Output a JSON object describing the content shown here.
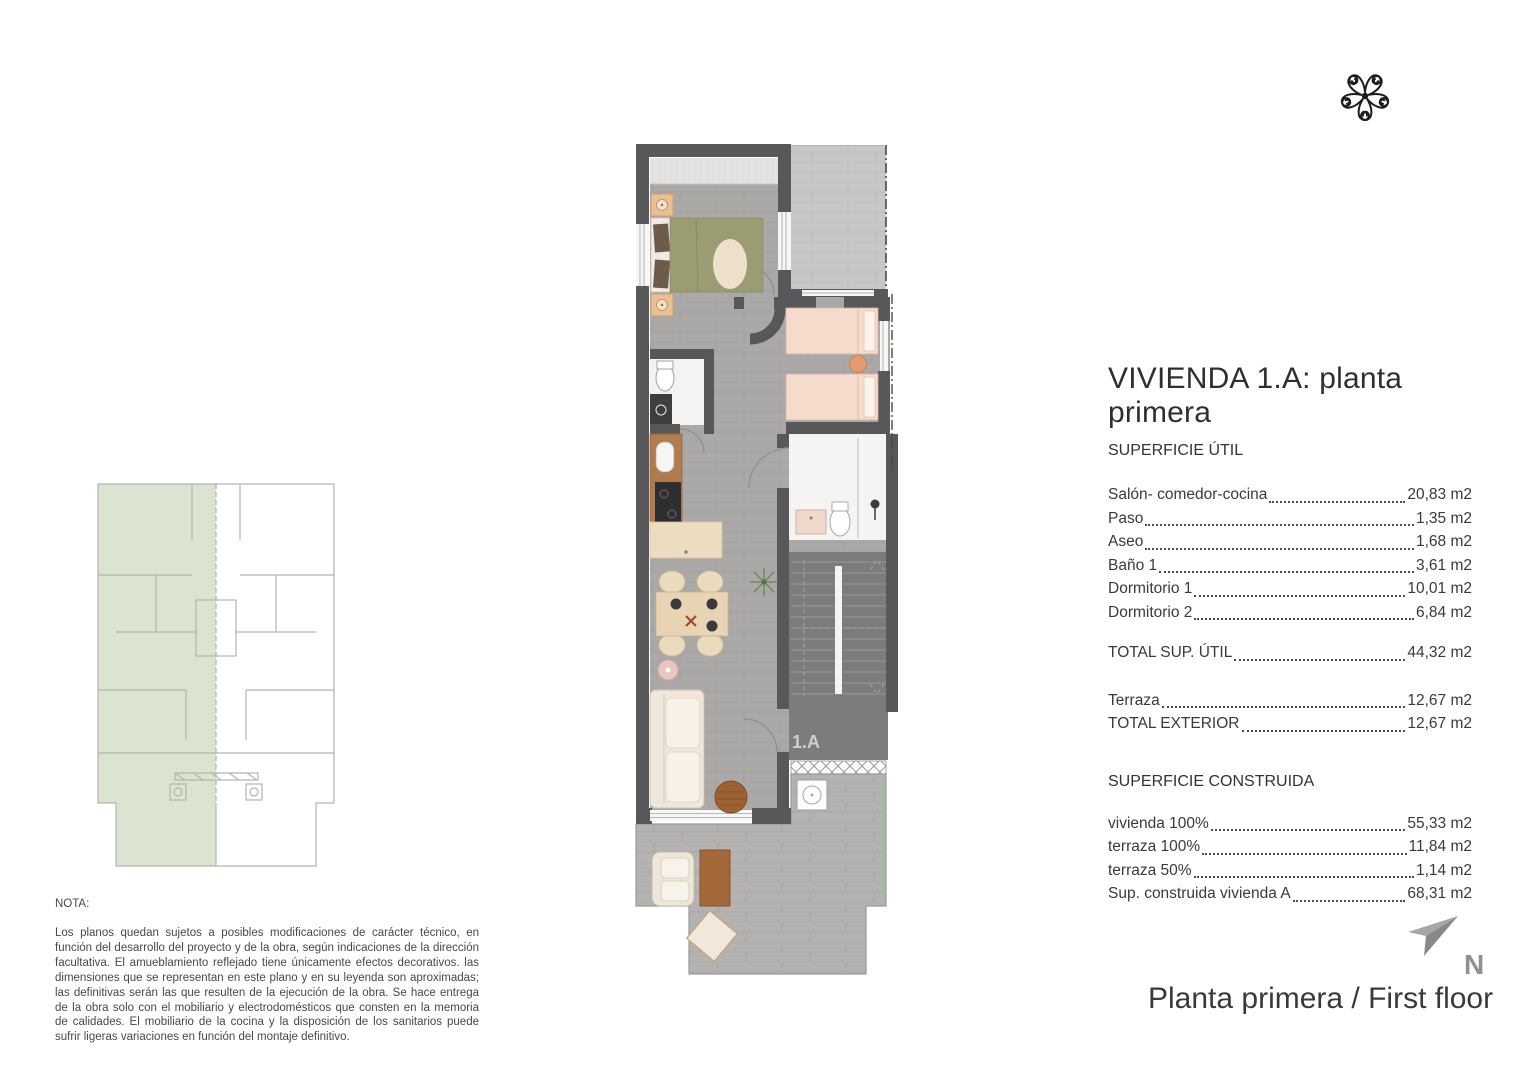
{
  "document": {
    "title": "VIVIENDA 1.A: planta primera",
    "footer_title": "Planta primera / First floor",
    "north_label": "N"
  },
  "superficie_util": {
    "heading": "SUPERFICIE ÚTIL",
    "rows": [
      {
        "label": "Salón- comedor-cocina",
        "value": "20,83 m2"
      },
      {
        "label": "Paso",
        "value": "1,35 m2"
      },
      {
        "label": "Aseo",
        "value": "1,68 m2"
      },
      {
        "label": "Baño 1",
        "value": "3,61 m2"
      },
      {
        "label": "Dormitorio 1",
        "value": "10,01 m2"
      },
      {
        "label": "Dormitorio 2",
        "value": "6,84 m2"
      }
    ],
    "total": {
      "label": "TOTAL SUP. ÚTIL",
      "value": "44,32 m2"
    },
    "exterior": [
      {
        "label": "Terraza",
        "value": "12,67 m2"
      },
      {
        "label": "TOTAL EXTERIOR",
        "value": "12,67 m2"
      }
    ]
  },
  "superficie_construida": {
    "heading": "SUPERFICIE CONSTRUIDA",
    "rows": [
      {
        "label": "vivienda 100% ",
        "value": "55,33 m2"
      },
      {
        "label": "terraza 100%",
        "value": "11,84 m2"
      },
      {
        "label": "terraza 50%",
        "value": "1,14 m2"
      },
      {
        "label": "Sup. construida vivienda A",
        "value": "68,31 m2"
      }
    ]
  },
  "nota": {
    "heading": "NOTA:",
    "body": "Los planos quedan sujetos a posibles modificaciones de carácter técnico, en función del desarrollo del proyecto y de la obra, según indicaciones de la dirección facultativa. El amueblamiento reflejado tiene únicamente efectos decorativos. las dimensiones que se representan en este plano y en su leyenda son aproximadas; las definitivas serán las que resulten de la ejecución de la obra. Se hace entrega de la obra solo con el mobiliario y electrodomésticos que consten en la memoria de calidades. El mobiliario de la cocina y la disposición de los sanitarios puede sufrir ligeras variaciones en función del montaje definitivo."
  },
  "plan": {
    "unit_label": "1.A"
  },
  "colors": {
    "wall": "#58585a",
    "floor": "#aaa9a7",
    "terrace_floor": "#c8c7c5",
    "stair_area": "#7d7c7a",
    "keyplan_highlight": "#cdd7bf",
    "bed_olive": "#9c9c73",
    "bed_pink": "#f5dbcc",
    "wood_counter": "#b07b4e",
    "railing_green": "#9fbb97"
  }
}
